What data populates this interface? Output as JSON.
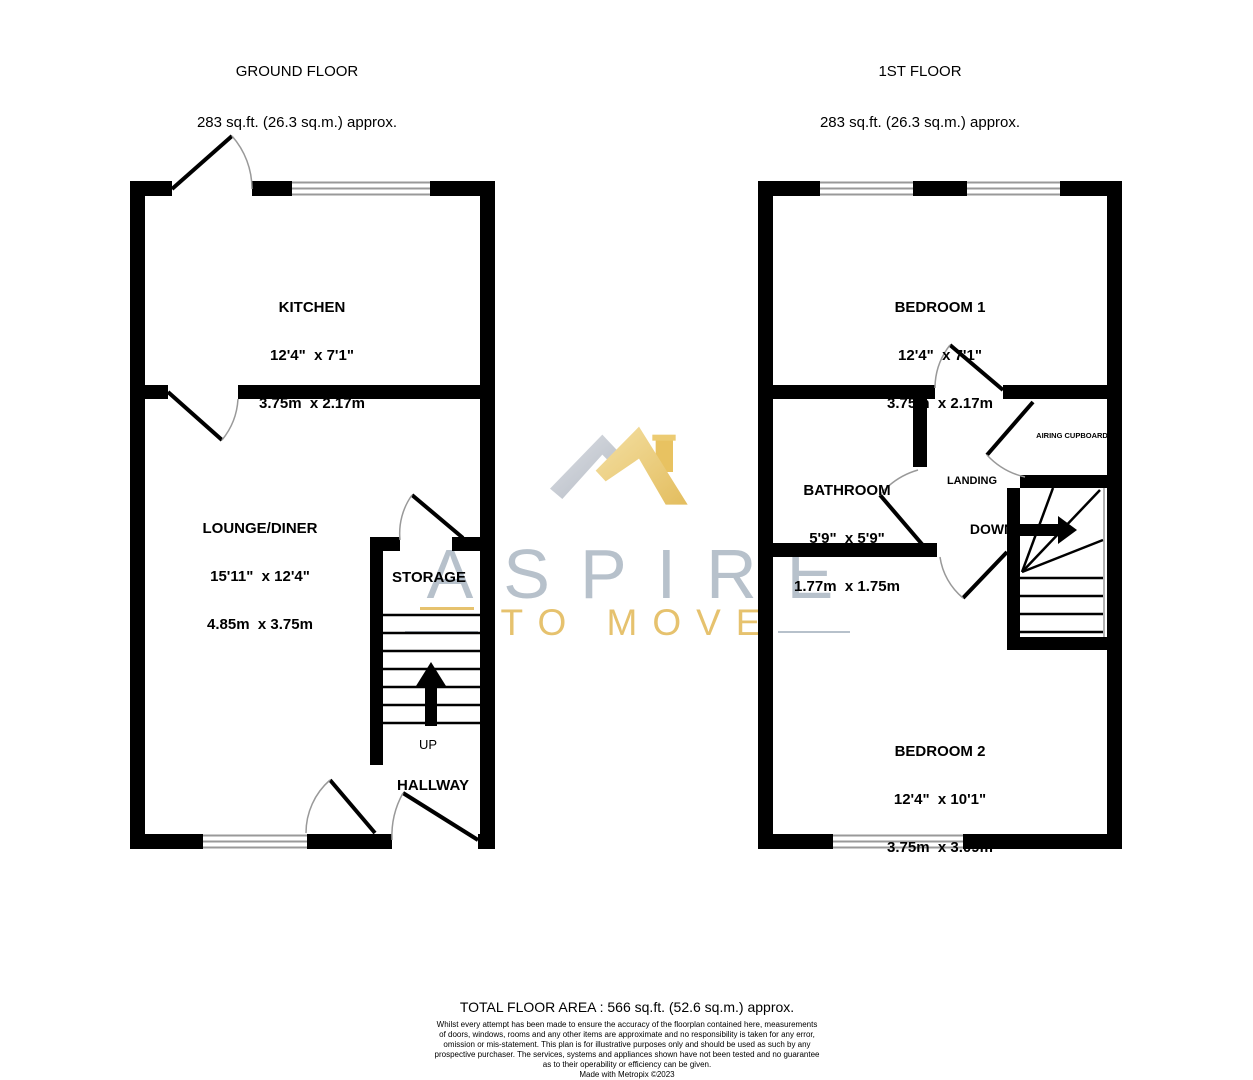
{
  "colors": {
    "wall": "#000000",
    "window_line": "#999999",
    "door_arc": "#999999",
    "logo_gray": "#b7c1cb",
    "logo_gold": "#e6c26e"
  },
  "headers": {
    "ground": {
      "title": "GROUND FLOOR",
      "area": "283 sq.ft. (26.3 sq.m.) approx."
    },
    "first": {
      "title": "1ST FLOOR",
      "area": "283 sq.ft. (26.3 sq.m.) approx."
    }
  },
  "ground_floor": {
    "kitchen": {
      "name": "KITCHEN",
      "imperial": "12'4\"  x 7'1\"",
      "metric": "3.75m  x 2.17m"
    },
    "lounge": {
      "name": "LOUNGE/DINER",
      "imperial": "15'11\"  x 12'4\"",
      "metric": "4.85m  x 3.75m"
    },
    "storage": {
      "name": "STORAGE"
    },
    "hallway": {
      "name": "HALLWAY"
    },
    "stairs_label": "UP"
  },
  "first_floor": {
    "bedroom1": {
      "name": "BEDROOM 1",
      "imperial": "12'4\"  x 7'1\"",
      "metric": "3.75m  x 2.17m"
    },
    "bathroom": {
      "name": "BATHROOM",
      "imperial": "5'9\"  x 5'9\"",
      "metric": "1.77m  x 1.75m"
    },
    "bedroom2": {
      "name": "BEDROOM 2",
      "imperial": "12'4\"  x 10'1\"",
      "metric": "3.75m  x 3.09m"
    },
    "landing": {
      "name": "LANDING"
    },
    "airing_cupboard": {
      "name": "AIRING CUPBOARD"
    },
    "stairs_label": "DOWN"
  },
  "watermark": {
    "brand": "ASPIRE",
    "tagline": "TO MOVE"
  },
  "footer": {
    "total_area": "TOTAL FLOOR AREA : 566 sq.ft. (52.6 sq.m.) approx.",
    "disclaimer": [
      "Whilst every attempt has been made to ensure the accuracy of the floorplan contained here, measurements",
      "of doors, windows, rooms and any other items are approximate and no responsibility is taken for any error,",
      "omission or mis-statement. This plan is for illustrative purposes only and should be used as such by any",
      "prospective purchaser. The services, systems and appliances shown have not been tested and no guarantee",
      "as to their operability or efficiency can be given."
    ],
    "credit": "Made with Metropix ©2023"
  }
}
